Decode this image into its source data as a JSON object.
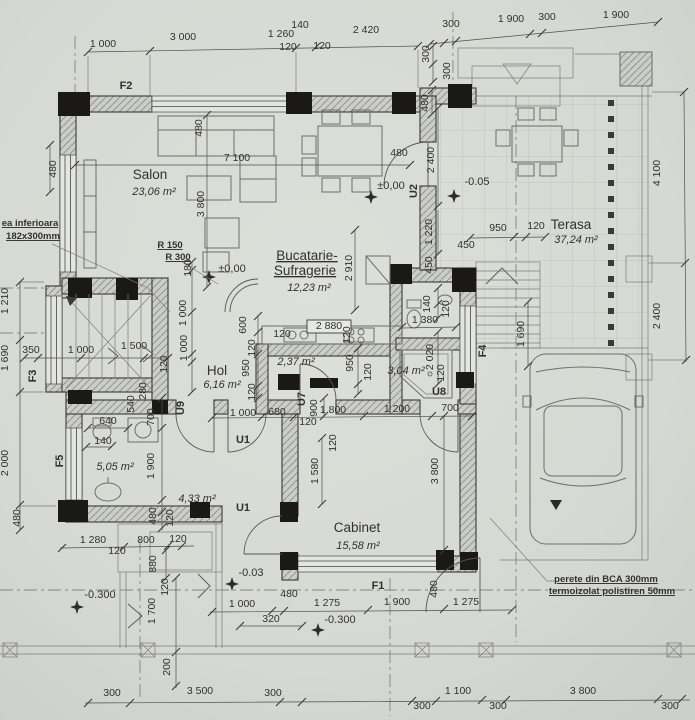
{
  "drawing": {
    "type": "ground-floor architectural plan (scanned)"
  },
  "colors": {
    "paper": "#d6d8d3",
    "ink": "#33312d",
    "wall_hatch": "#cbcdc8",
    "column": "#1b1915"
  },
  "rooms": {
    "salon": {
      "name": "Salon",
      "area": "23,06 m²"
    },
    "bucatarie": {
      "name1": "Bucatarie-",
      "name2": "Sufragerie",
      "area": "12,23 m²"
    },
    "hol": {
      "name": "Hol",
      "area": "6,16 m²"
    },
    "terasa": {
      "name": "Terasa",
      "area": "37,24 m²"
    },
    "cabinet": {
      "name": "Cabinet",
      "area": "15,58 m²"
    },
    "camera237": {
      "area": "2,37 m²"
    },
    "dus304": {
      "area": "3,04 m²"
    },
    "baie505": {
      "area": "5,05 m²"
    },
    "hol433": {
      "area": "4,33 m²"
    }
  },
  "notes": {
    "stair_note_line1": "ea inferioara",
    "stair_note_line2": "182x300mm",
    "radius_note_1": "R 150",
    "radius_note_2": "R 300",
    "wall_note_line1": "perete din BCA 300mm",
    "wall_note_line2": "termoizolat polistiren 50mm"
  },
  "levels": [
    {
      "t": "±0,00",
      "x": 232,
      "y": 272
    },
    {
      "t": "±0,00",
      "x": 391,
      "y": 189
    },
    {
      "t": "-0.05",
      "x": 477,
      "y": 185
    },
    {
      "t": "-0.03",
      "x": 251,
      "y": 576
    },
    {
      "t": "-0.300",
      "x": 100,
      "y": 598
    },
    {
      "t": "-0.300",
      "x": 340,
      "y": 623
    }
  ],
  "opening_tags": [
    {
      "t": "F2",
      "x": 126,
      "y": 89
    },
    {
      "t": "F1",
      "x": 378,
      "y": 589
    },
    {
      "t": "F3",
      "x": 36,
      "y": 376,
      "r": -90
    },
    {
      "t": "F4",
      "x": 486,
      "y": 351,
      "r": -90
    },
    {
      "t": "F5",
      "x": 63,
      "y": 461,
      "r": -90
    },
    {
      "t": "U1",
      "x": 243,
      "y": 443
    },
    {
      "t": "U1",
      "x": 243,
      "y": 511
    },
    {
      "t": "U2",
      "x": 417,
      "y": 191,
      "r": -90
    },
    {
      "t": "U7",
      "x": 305,
      "y": 399,
      "r": -90
    },
    {
      "t": "U8",
      "x": 439,
      "y": 395
    },
    {
      "t": "U9",
      "x": 184,
      "y": 408,
      "r": -90
    }
  ],
  "dim_labels": [
    {
      "t": "1 000",
      "x": 103,
      "y": 47
    },
    {
      "t": "3 000",
      "x": 183,
      "y": 40
    },
    {
      "t": "1 260",
      "x": 281,
      "y": 37
    },
    {
      "t": "140",
      "x": 300,
      "y": 28
    },
    {
      "t": "120",
      "x": 288,
      "y": 50
    },
    {
      "t": "120",
      "x": 322,
      "y": 49
    },
    {
      "t": "2 420",
      "x": 366,
      "y": 33
    },
    {
      "t": "300",
      "x": 451,
      "y": 27
    },
    {
      "t": "1 900",
      "x": 511,
      "y": 22
    },
    {
      "t": "300",
      "x": 547,
      "y": 20
    },
    {
      "t": "1 900",
      "x": 616,
      "y": 18
    },
    {
      "t": "300",
      "x": 429,
      "y": 54,
      "r": -90
    },
    {
      "t": "300",
      "x": 450,
      "y": 71,
      "r": -90
    },
    {
      "t": "480",
      "x": 428,
      "y": 103,
      "r": -90
    },
    {
      "t": "480",
      "x": 202,
      "y": 128,
      "r": -90
    },
    {
      "t": "7 100",
      "x": 237,
      "y": 161
    },
    {
      "t": "3 800",
      "x": 204,
      "y": 204,
      "r": -90
    },
    {
      "t": "2 400",
      "x": 434,
      "y": 160,
      "r": -90
    },
    {
      "t": "480",
      "x": 399,
      "y": 156
    },
    {
      "t": "1 220",
      "x": 432,
      "y": 232,
      "r": -90
    },
    {
      "t": "450",
      "x": 432,
      "y": 265,
      "r": -90
    },
    {
      "t": "950",
      "x": 498,
      "y": 231
    },
    {
      "t": "120",
      "x": 536,
      "y": 229
    },
    {
      "t": "450",
      "x": 466,
      "y": 248
    },
    {
      "t": "2 910",
      "x": 352,
      "y": 268,
      "r": -90
    },
    {
      "t": "140",
      "x": 430,
      "y": 304,
      "r": -90
    },
    {
      "t": "120",
      "x": 449,
      "y": 309,
      "r": -90
    },
    {
      "t": "1 380",
      "x": 425,
      "y": 323
    },
    {
      "t": "2 020",
      "x": 433,
      "y": 357,
      "r": -90
    },
    {
      "t": "120",
      "x": 444,
      "y": 373,
      "r": -90
    },
    {
      "t": "1 690",
      "x": 524,
      "y": 334,
      "r": -90
    },
    {
      "t": "4 100",
      "x": 660,
      "y": 173,
      "r": -90
    },
    {
      "t": "2 400",
      "x": 660,
      "y": 316,
      "r": -90
    },
    {
      "t": "480",
      "x": 56,
      "y": 169,
      "r": -90
    },
    {
      "t": "1 210",
      "x": 8,
      "y": 301,
      "r": -90
    },
    {
      "t": "1 690",
      "x": 8,
      "y": 358,
      "r": -90
    },
    {
      "t": "2 000",
      "x": 8,
      "y": 463,
      "r": -90
    },
    {
      "t": "480",
      "x": 20,
      "y": 518,
      "r": -90
    },
    {
      "t": "350",
      "x": 31,
      "y": 353
    },
    {
      "t": "1 000",
      "x": 81,
      "y": 353
    },
    {
      "t": "1 500",
      "x": 134,
      "y": 349
    },
    {
      "t": "180",
      "x": 191,
      "y": 268,
      "r": -90
    },
    {
      "t": "1 000",
      "x": 186,
      "y": 313,
      "r": -90
    },
    {
      "t": "1 000",
      "x": 187,
      "y": 348,
      "r": -90
    },
    {
      "t": "120",
      "x": 167,
      "y": 364,
      "r": -90
    },
    {
      "t": "280",
      "x": 146,
      "y": 391,
      "r": -90
    },
    {
      "t": "540",
      "x": 134,
      "y": 404,
      "r": -90
    },
    {
      "t": "640",
      "x": 108,
      "y": 424
    },
    {
      "t": "140",
      "x": 103,
      "y": 444
    },
    {
      "t": "700",
      "x": 154,
      "y": 417,
      "r": -90
    },
    {
      "t": "1 900",
      "x": 154,
      "y": 466,
      "r": -90
    },
    {
      "t": "480",
      "x": 156,
      "y": 516,
      "r": -90
    },
    {
      "t": "120",
      "x": 173,
      "y": 518,
      "r": -90
    },
    {
      "t": "600",
      "x": 246,
      "y": 325,
      "r": -90
    },
    {
      "t": "120",
      "x": 255,
      "y": 348,
      "r": -90
    },
    {
      "t": "950",
      "x": 249,
      "y": 368,
      "r": -90
    },
    {
      "t": "120",
      "x": 255,
      "y": 392,
      "r": -90
    },
    {
      "t": "120",
      "x": 282,
      "y": 337
    },
    {
      "t": "120",
      "x": 350,
      "y": 335,
      "r": -90
    },
    {
      "t": "950",
      "x": 353,
      "y": 363,
      "r": -90
    },
    {
      "t": "120",
      "x": 371,
      "y": 372,
      "r": -90
    },
    {
      "t": "900",
      "x": 317,
      "y": 408,
      "r": -90
    },
    {
      "t": "1 000",
      "x": 243,
      "y": 416
    },
    {
      "t": "680",
      "x": 277,
      "y": 415
    },
    {
      "t": "1 800",
      "x": 333,
      "y": 413
    },
    {
      "t": "1 200",
      "x": 397,
      "y": 412
    },
    {
      "t": "700",
      "x": 450,
      "y": 411
    },
    {
      "t": "120",
      "x": 308,
      "y": 425
    },
    {
      "t": "120",
      "x": 336,
      "y": 443,
      "r": -90
    },
    {
      "t": "1 580",
      "x": 318,
      "y": 471,
      "r": -90
    },
    {
      "t": "3 800",
      "x": 438,
      "y": 471,
      "r": -90
    },
    {
      "t": "480",
      "x": 289,
      "y": 597
    },
    {
      "t": "1 000",
      "x": 242,
      "y": 607
    },
    {
      "t": "1 275",
      "x": 327,
      "y": 606
    },
    {
      "t": "1 900",
      "x": 397,
      "y": 605
    },
    {
      "t": "1 275",
      "x": 466,
      "y": 605
    },
    {
      "t": "320",
      "x": 271,
      "y": 622
    },
    {
      "t": "480",
      "x": 437,
      "y": 589,
      "r": -90
    },
    {
      "t": "1 280",
      "x": 93,
      "y": 543
    },
    {
      "t": "800",
      "x": 146,
      "y": 543
    },
    {
      "t": "120",
      "x": 178,
      "y": 542
    },
    {
      "t": "120",
      "x": 117,
      "y": 554
    },
    {
      "t": "880",
      "x": 156,
      "y": 564,
      "r": -90
    },
    {
      "t": "120",
      "x": 168,
      "y": 587,
      "r": -90
    },
    {
      "t": "1 700",
      "x": 155,
      "y": 611,
      "r": -90
    },
    {
      "t": "200",
      "x": 170,
      "y": 667,
      "r": -90
    },
    {
      "t": "300",
      "x": 112,
      "y": 696
    },
    {
      "t": "3 500",
      "x": 200,
      "y": 694
    },
    {
      "t": "300",
      "x": 273,
      "y": 696
    },
    {
      "t": "300",
      "x": 422,
      "y": 709
    },
    {
      "t": "1 100",
      "x": 458,
      "y": 694
    },
    {
      "t": "300",
      "x": 498,
      "y": 709
    },
    {
      "t": "3 800",
      "x": 583,
      "y": 694
    },
    {
      "t": "300",
      "x": 670,
      "y": 709
    },
    {
      "t": "2 880",
      "x": 329,
      "y": 329
    }
  ]
}
